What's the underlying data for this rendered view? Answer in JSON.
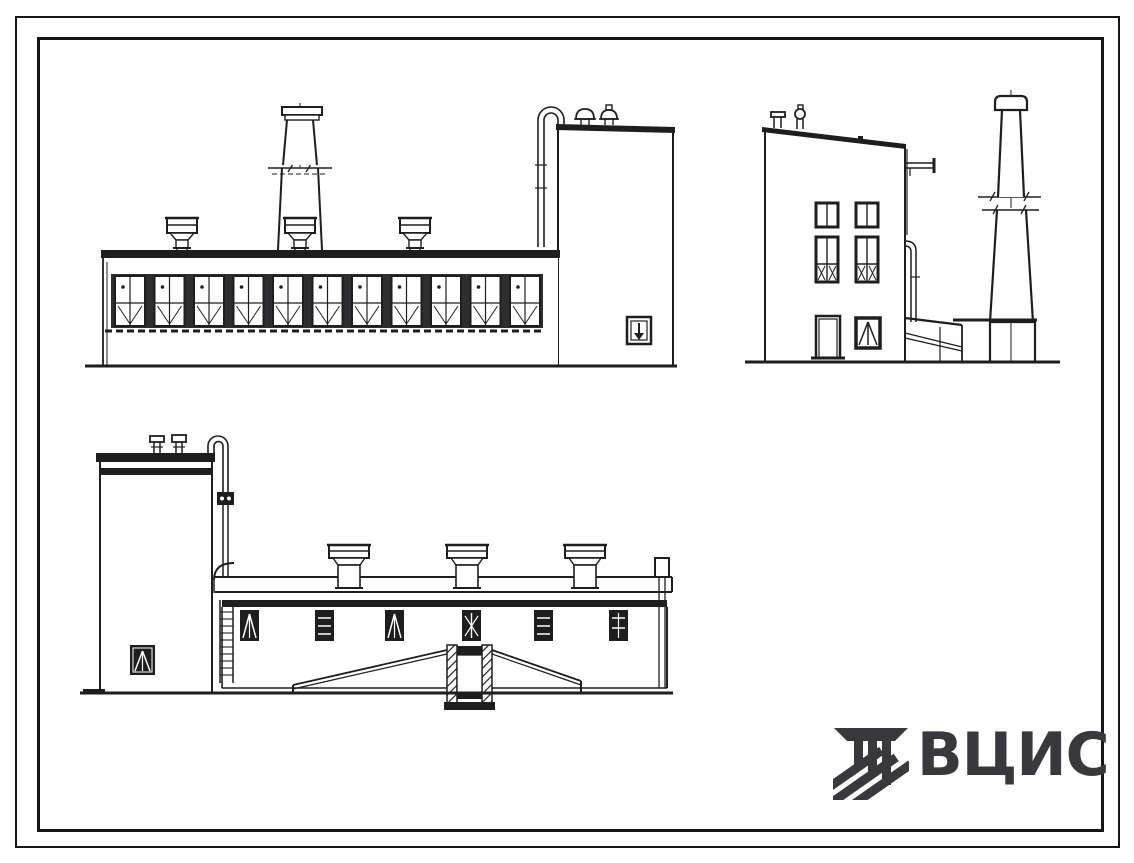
{
  "colors": {
    "background": "#ffffff",
    "paper": "#fefefe",
    "ink": "#1e1e1e",
    "frame": "#161616",
    "logo": "#39393d"
  },
  "logo": {
    "text": "ВЦИС",
    "emblem_icon": "vcis-emblem"
  },
  "sheet": {
    "type": "scanned architectural elevation drawing, black ink on white",
    "drawings": {
      "front_elevation": {
        "name": "front-elevation-drawing",
        "window_bays": 11,
        "roof_deflectors": 3,
        "chimney_with_break_lines": 1,
        "annex_roof_vents": 2,
        "gooseneck_pipe": 1,
        "down_arrow_wall_sign": 1
      },
      "side_elevation": {
        "name": "side-elevation-drawing",
        "upper_windows": 2,
        "middle_windows": 2,
        "door": 1,
        "triangle_window": 1,
        "roof_vents": 2,
        "wall_pipe_flange": 1,
        "chimney_with_break_lines": 1
      },
      "rear_elevation": {
        "name": "rear-elevation-drawing",
        "tower_roof_pipes": 2,
        "gooseneck_pipe": 1,
        "ladder": 1,
        "roof_deflectors": 3,
        "wall_windows": 6,
        "tower_window": 1,
        "central_hatched_portal": 1,
        "canopy_slopes": 2
      }
    }
  }
}
